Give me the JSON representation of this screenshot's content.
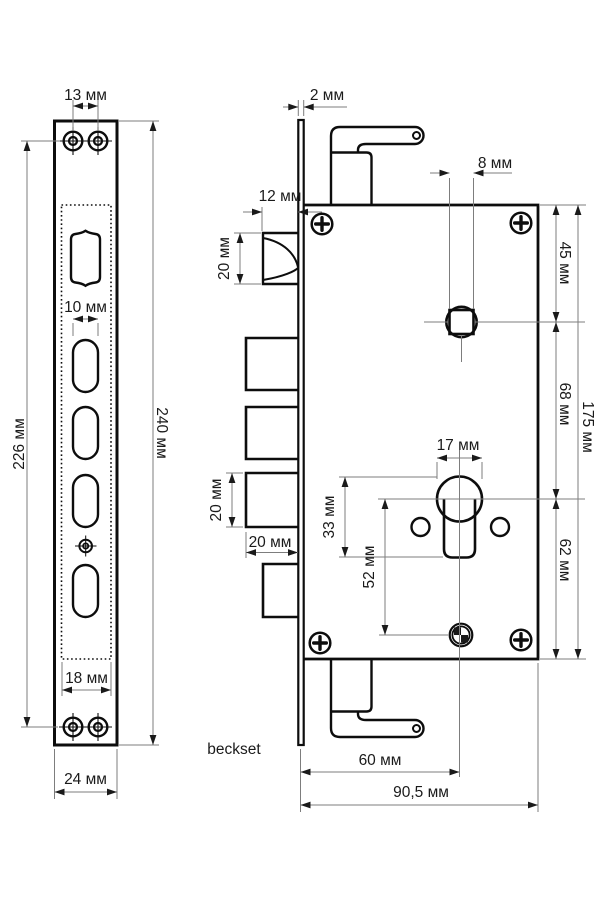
{
  "caption": "beckset",
  "faceplate": {
    "screw_spacing": "13 мм",
    "hole_width": "10 мм",
    "screw_centers": "226 мм",
    "height": "240 мм",
    "cutout_width": "18 мм",
    "width": "24 мм",
    "thickness": "2 мм"
  },
  "body": {
    "latch_protrusion": "12 мм",
    "latch_height": "20 мм",
    "top_to_spindle": "45 мм",
    "spindle_square": "8 мм",
    "spindle_to_cylinder": "68 мм",
    "height": "175 мм",
    "cylinder_diameter": "17 мм",
    "cylinder_profile_height": "33 мм",
    "cylinder_to_fixing_hole": "52 мм",
    "cylinder_to_bottom": "62 мм",
    "bolt_height": "20 мм",
    "bolt_width": "20 мм",
    "backset": "60 мм",
    "width": "90,5 мм"
  },
  "colors": {
    "background": "#ffffff",
    "outline": "#0d0d0d",
    "dimension_lines": "#7d7d7d",
    "labels": "#1a1a1a"
  }
}
